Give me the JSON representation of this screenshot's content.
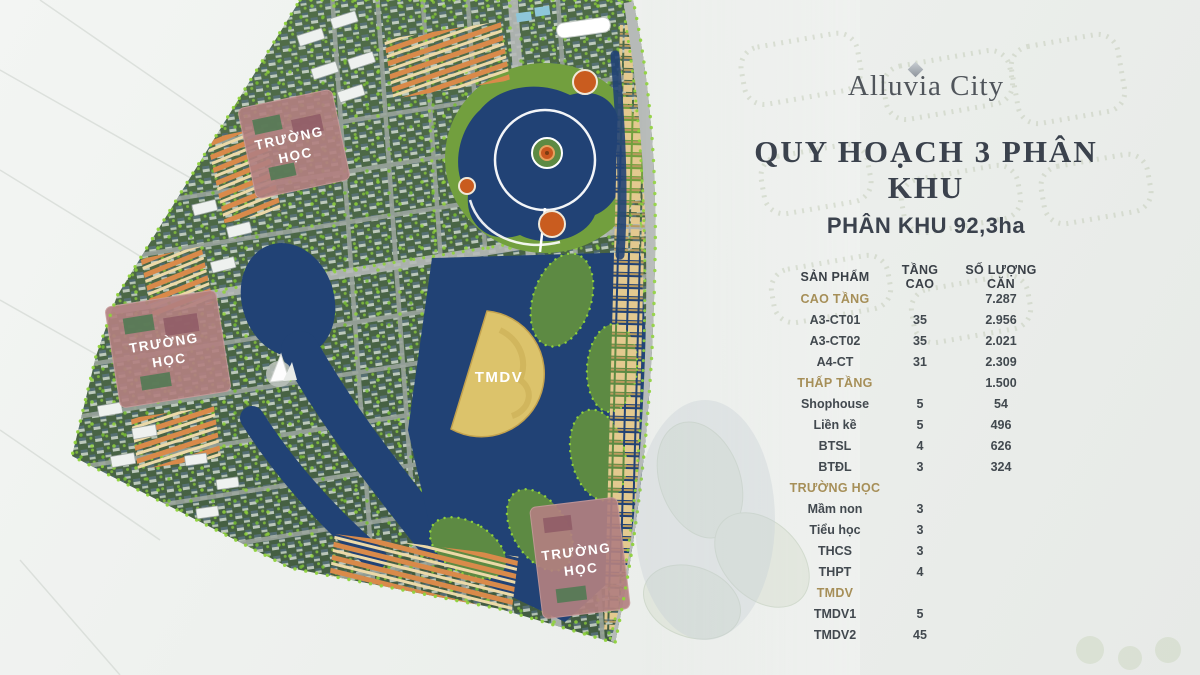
{
  "brand": {
    "name": "Alluvia City",
    "icon": "diamond-icon"
  },
  "heading": {
    "title": "QUY HOẠCH 3 PHÂN KHU",
    "subtitle": "PHÂN KHU 92,3ha"
  },
  "table": {
    "columns": [
      "SẢN PHẨM",
      "TẦNG CAO",
      "SỐ LƯỢNG CĂN"
    ],
    "rows": [
      {
        "type": "category",
        "name": "CAO TẦNG",
        "floors": "",
        "units": "7.287"
      },
      {
        "type": "item",
        "name": "A3-CT01",
        "floors": "35",
        "units": "2.956"
      },
      {
        "type": "item",
        "name": "A3-CT02",
        "floors": "35",
        "units": "2.021"
      },
      {
        "type": "item",
        "name": "A4-CT",
        "floors": "31",
        "units": "2.309"
      },
      {
        "type": "category",
        "name": "THẤP TẦNG",
        "floors": "",
        "units": "1.500"
      },
      {
        "type": "item",
        "name": "Shophouse",
        "floors": "5",
        "units": "54"
      },
      {
        "type": "item",
        "name": "Liền kề",
        "floors": "5",
        "units": "496"
      },
      {
        "type": "item",
        "name": "BTSL",
        "floors": "4",
        "units": "626"
      },
      {
        "type": "item",
        "name": "BTĐL",
        "floors": "3",
        "units": "324"
      },
      {
        "type": "category",
        "name": "TRƯỜNG HỌC",
        "floors": "",
        "units": ""
      },
      {
        "type": "item",
        "name": "Mầm non",
        "floors": "3",
        "units": ""
      },
      {
        "type": "item",
        "name": "Tiểu học",
        "floors": "3",
        "units": ""
      },
      {
        "type": "item",
        "name": "THCS",
        "floors": "3",
        "units": ""
      },
      {
        "type": "item",
        "name": "THPT",
        "floors": "4",
        "units": ""
      },
      {
        "type": "category",
        "name": "TMDV",
        "floors": "",
        "units": ""
      },
      {
        "type": "item",
        "name": "TMDV1",
        "floors": "5",
        "units": ""
      },
      {
        "type": "item",
        "name": "TMDV2",
        "floors": "45",
        "units": ""
      }
    ]
  },
  "map": {
    "zones": {
      "school": {
        "label_lines": [
          "TRƯỜNG",
          "HỌC"
        ],
        "count": 3
      },
      "tmdv": {
        "label": "TMDV"
      }
    },
    "colors": {
      "water": "#214275",
      "park": "#729f3e",
      "trees": "#8fd23c",
      "school_zone": "#b28080",
      "tmdv_zone": "#dcc36b",
      "townhouse_roof": "#d98a4a",
      "plaza": "#c95c1f",
      "accent_gold": "#a68f58",
      "heading_text": "#3b424d"
    }
  }
}
